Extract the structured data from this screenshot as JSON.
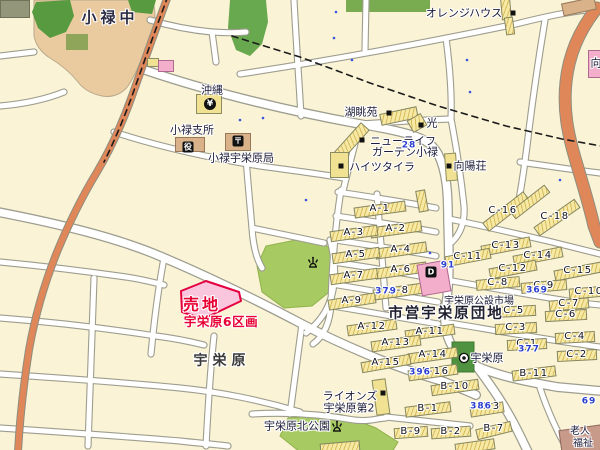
{
  "colors": {
    "background": "#FAF3D5",
    "road_fill": "#FFFFFF",
    "road_casing": "#9D9D8F",
    "main_road_orange": "#DF8759",
    "school_ground_tan": "#EACBA0",
    "park_green": "#A7CB62",
    "dark_green": "#579A40",
    "apartment_yellow": "#F6E9A4",
    "sale_site_pink": "#F9C6DD",
    "sale_site_red": "#E80033",
    "market_pink": "#F3AECB",
    "label_navy": "#1C1C3A",
    "blue_number": "#2A3FD0"
  },
  "map": {
    "labels": [
      {
        "text": "小禄中",
        "x": 110,
        "y": 18,
        "k": "place-lg",
        "name": "label-oroku-junior-high"
      },
      {
        "text": "オレンジハウス",
        "x": 464,
        "y": 13,
        "k": "fac",
        "name": "label-orange-house"
      },
      {
        "text": "沖縄",
        "x": 212,
        "y": 90,
        "k": "fac",
        "name": "label-okinawa-bank"
      },
      {
        "text": "湖眺苑",
        "x": 361,
        "y": 112,
        "k": "fac",
        "name": "label-kochoen"
      },
      {
        "text": "光",
        "x": 432,
        "y": 123,
        "k": "fac",
        "name": "label-hikari"
      },
      {
        "text": "ニューライフ",
        "x": 403,
        "y": 141,
        "k": "fac",
        "name": "label-new-life-line1"
      },
      {
        "text": "ガーデン小禄",
        "x": 405,
        "y": 152,
        "k": "fac",
        "name": "label-new-life-line2"
      },
      {
        "text": "ハイツタイラ",
        "x": 382,
        "y": 167,
        "k": "fac",
        "name": "label-heights-taira"
      },
      {
        "text": "向陽荘",
        "x": 470,
        "y": 166,
        "k": "fac",
        "name": "label-koyoso"
      },
      {
        "text": "小禄支所",
        "x": 192,
        "y": 130,
        "k": "fac",
        "name": "label-oroku-branch-office"
      },
      {
        "text": "小禄宇栄原局",
        "x": 241,
        "y": 158,
        "k": "fac",
        "name": "label-oroku-uebaru-post-office"
      },
      {
        "text": "宇栄原公設市場",
        "x": 479,
        "y": 302,
        "k": "fac-sm",
        "name": "label-uebaru-public-market"
      },
      {
        "text": "市営宇栄原団地",
        "x": 446,
        "y": 314,
        "k": "place-md",
        "name": "label-shiei-uebaru-danchi"
      },
      {
        "text": "宇栄原",
        "x": 222,
        "y": 361,
        "k": "place",
        "name": "label-uebaru"
      },
      {
        "text": "ライオンズ",
        "x": 350,
        "y": 396,
        "k": "fac",
        "name": "label-lions-line1"
      },
      {
        "text": "宇栄原第2",
        "x": 349,
        "y": 408,
        "k": "fac",
        "name": "label-lions-line2"
      },
      {
        "text": "宇栄原北公園",
        "x": 297,
        "y": 426,
        "k": "fac",
        "name": "label-uebaru-kita-park"
      },
      {
        "text": "宇栄原",
        "x": 487,
        "y": 358,
        "k": "fac",
        "name": "label-uebaru-bus-stop"
      },
      {
        "text": "老人",
        "x": 580,
        "y": 432,
        "k": "fac-sm",
        "name": "label-rojin-line1"
      },
      {
        "text": "福祉",
        "x": 583,
        "y": 444,
        "k": "fac-sm",
        "name": "label-rojin-line2"
      },
      {
        "text": "向",
        "x": 596,
        "y": 63,
        "k": "fac",
        "name": "label-mukai-partial"
      },
      {
        "text": "売地",
        "x": 202,
        "y": 305,
        "k": "sale1",
        "name": "sale-site-label"
      },
      {
        "text": "宇栄原6区画",
        "x": 221,
        "y": 322,
        "k": "sale2",
        "name": "sale-site-sublabel"
      },
      {
        "text": "A-1",
        "x": 380,
        "y": 209,
        "k": "block"
      },
      {
        "text": "A-2",
        "x": 396,
        "y": 229,
        "k": "block"
      },
      {
        "text": "A-3",
        "x": 354,
        "y": 233,
        "k": "block"
      },
      {
        "text": "A-4",
        "x": 401,
        "y": 250,
        "k": "block"
      },
      {
        "text": "A-5",
        "x": 356,
        "y": 255,
        "k": "block"
      },
      {
        "text": "A-6",
        "x": 401,
        "y": 270,
        "k": "block"
      },
      {
        "text": "A-7",
        "x": 354,
        "y": 276,
        "k": "block"
      },
      {
        "text": "A-8",
        "x": 399,
        "y": 291,
        "k": "block"
      },
      {
        "text": "A-9",
        "x": 352,
        "y": 301,
        "k": "block"
      },
      {
        "text": "A-11",
        "x": 430,
        "y": 332,
        "k": "block"
      },
      {
        "text": "A-12",
        "x": 372,
        "y": 327,
        "k": "block"
      },
      {
        "text": "A-13",
        "x": 396,
        "y": 343,
        "k": "block"
      },
      {
        "text": "A-14",
        "x": 433,
        "y": 355,
        "k": "block"
      },
      {
        "text": "A-15",
        "x": 386,
        "y": 363,
        "k": "block"
      },
      {
        "text": "A-16",
        "x": 435,
        "y": 372,
        "k": "block"
      },
      {
        "text": "B-1",
        "x": 428,
        "y": 409,
        "k": "block"
      },
      {
        "text": "B-2",
        "x": 451,
        "y": 432,
        "k": "block"
      },
      {
        "text": "B-3",
        "x": 490,
        "y": 407,
        "k": "block"
      },
      {
        "text": "B-7",
        "x": 494,
        "y": 429,
        "k": "block"
      },
      {
        "text": "B-9",
        "x": 411,
        "y": 432,
        "k": "block"
      },
      {
        "text": "B-10",
        "x": 455,
        "y": 387,
        "k": "block"
      },
      {
        "text": "B-11",
        "x": 534,
        "y": 374,
        "k": "block"
      },
      {
        "text": "C-1",
        "x": 527,
        "y": 344,
        "k": "block"
      },
      {
        "text": "C-2",
        "x": 577,
        "y": 355,
        "k": "block"
      },
      {
        "text": "C-3",
        "x": 516,
        "y": 328,
        "k": "block"
      },
      {
        "text": "C-4",
        "x": 575,
        "y": 337,
        "k": "block"
      },
      {
        "text": "C-5",
        "x": 514,
        "y": 311,
        "k": "block"
      },
      {
        "text": "C-6",
        "x": 566,
        "y": 315,
        "k": "block"
      },
      {
        "text": "C-7",
        "x": 569,
        "y": 304,
        "k": "block"
      },
      {
        "text": "C-8",
        "x": 498,
        "y": 283,
        "k": "block"
      },
      {
        "text": "C-9",
        "x": 544,
        "y": 286,
        "k": "block"
      },
      {
        "text": "C-10",
        "x": 589,
        "y": 292,
        "k": "block"
      },
      {
        "text": "C-11",
        "x": 468,
        "y": 257,
        "k": "block"
      },
      {
        "text": "C-12",
        "x": 513,
        "y": 269,
        "k": "block"
      },
      {
        "text": "C-13",
        "x": 506,
        "y": 246,
        "k": "block"
      },
      {
        "text": "C-14",
        "x": 538,
        "y": 256,
        "k": "block"
      },
      {
        "text": "C-15",
        "x": 578,
        "y": 271,
        "k": "block"
      },
      {
        "text": "C-16",
        "x": 503,
        "y": 211,
        "k": "block"
      },
      {
        "text": "C-18",
        "x": 555,
        "y": 217,
        "k": "block"
      },
      {
        "text": "379",
        "x": 386,
        "y": 292,
        "k": "blue"
      },
      {
        "text": "369",
        "x": 537,
        "y": 291,
        "k": "blue"
      },
      {
        "text": "377",
        "x": 529,
        "y": 350,
        "k": "blue"
      },
      {
        "text": "396",
        "x": 420,
        "y": 373,
        "k": "blue"
      },
      {
        "text": "386",
        "x": 481,
        "y": 407,
        "k": "blue"
      },
      {
        "text": "91",
        "x": 448,
        "y": 266,
        "k": "blue"
      },
      {
        "text": "69",
        "x": 589,
        "y": 402,
        "k": "blue"
      },
      {
        "text": "28",
        "x": 409,
        "y": 146,
        "k": "blue"
      }
    ],
    "buildings": [
      {
        "n": "apartment-bar-a1",
        "k": "bar",
        "x": 380,
        "y": 209,
        "w": 52,
        "h": 11,
        "a": -8
      },
      {
        "n": "apartment-bar-a2",
        "k": "bar",
        "x": 396,
        "y": 229,
        "w": 52,
        "h": 11,
        "a": -8
      },
      {
        "n": "apartment-bar-a3",
        "k": "bar",
        "x": 354,
        "y": 233,
        "w": 48,
        "h": 11,
        "a": -8
      },
      {
        "n": "apartment-bar-a4",
        "k": "bar",
        "x": 401,
        "y": 250,
        "w": 52,
        "h": 11,
        "a": -8
      },
      {
        "n": "apartment-bar-a5",
        "k": "bar",
        "x": 356,
        "y": 255,
        "w": 48,
        "h": 11,
        "a": -8
      },
      {
        "n": "apartment-bar-a6",
        "k": "bar",
        "x": 401,
        "y": 270,
        "w": 52,
        "h": 11,
        "a": -8
      },
      {
        "n": "apartment-bar-a7",
        "k": "bar",
        "x": 354,
        "y": 276,
        "w": 48,
        "h": 11,
        "a": -8
      },
      {
        "n": "apartment-bar-a8",
        "k": "bar",
        "x": 399,
        "y": 291,
        "w": 52,
        "h": 11,
        "a": -8
      },
      {
        "n": "apartment-bar-a9",
        "k": "bar",
        "x": 352,
        "y": 301,
        "w": 48,
        "h": 11,
        "a": -9
      },
      {
        "n": "apartment-bar-a11",
        "k": "bar",
        "x": 430,
        "y": 332,
        "w": 50,
        "h": 11,
        "a": -8
      },
      {
        "n": "apartment-bar-a12",
        "k": "bar",
        "x": 372,
        "y": 327,
        "w": 50,
        "h": 11,
        "a": -8
      },
      {
        "n": "apartment-bar-a13",
        "k": "bar",
        "x": 396,
        "y": 343,
        "w": 50,
        "h": 11,
        "a": -8
      },
      {
        "n": "apartment-bar-a14",
        "k": "bar",
        "x": 433,
        "y": 355,
        "w": 50,
        "h": 11,
        "a": -8
      },
      {
        "n": "apartment-bar-a15",
        "k": "bar",
        "x": 386,
        "y": 363,
        "w": 50,
        "h": 11,
        "a": -10
      },
      {
        "n": "apartment-bar-a16",
        "k": "bar",
        "x": 433,
        "y": 372,
        "w": 50,
        "h": 11,
        "a": -8
      },
      {
        "n": "apartment-bar-b1",
        "k": "bar",
        "x": 428,
        "y": 409,
        "w": 46,
        "h": 11,
        "a": -7
      },
      {
        "n": "apartment-bar-b2",
        "k": "bar",
        "x": 451,
        "y": 432,
        "w": 40,
        "h": 11,
        "a": -4
      },
      {
        "n": "apartment-bar-b3",
        "k": "bar",
        "x": 487,
        "y": 409,
        "w": 34,
        "h": 11,
        "a": -9
      },
      {
        "n": "apartment-bar-b7",
        "k": "bar",
        "x": 494,
        "y": 430,
        "w": 36,
        "h": 11,
        "a": -14
      },
      {
        "n": "apartment-bar-b9",
        "k": "bar",
        "x": 411,
        "y": 432,
        "w": 34,
        "h": 11,
        "a": -4
      },
      {
        "n": "apartment-bar-b10",
        "k": "bar",
        "x": 455,
        "y": 387,
        "w": 48,
        "h": 11,
        "a": -8
      },
      {
        "n": "apartment-bar-b11",
        "k": "bar",
        "x": 534,
        "y": 373,
        "w": 44,
        "h": 11,
        "a": -7
      },
      {
        "n": "apartment-bar-c16",
        "k": "bar",
        "x": 506,
        "y": 211,
        "w": 52,
        "h": 11,
        "a": -38
      },
      {
        "n": "apartment-bar",
        "k": "bar",
        "x": 530,
        "y": 202,
        "w": 44,
        "h": 10,
        "a": -38
      },
      {
        "n": "apartment-bar-c18",
        "k": "bar",
        "x": 557,
        "y": 217,
        "w": 50,
        "h": 11,
        "a": -35
      },
      {
        "n": "apartment-bar-c13",
        "k": "bar",
        "x": 506,
        "y": 246,
        "w": 50,
        "h": 11,
        "a": -11
      },
      {
        "n": "apartment-bar-c11",
        "k": "bar",
        "x": 468,
        "y": 257,
        "w": 46,
        "h": 11,
        "a": -11
      },
      {
        "n": "apartment-bar-c14",
        "k": "bar",
        "x": 538,
        "y": 256,
        "w": 50,
        "h": 11,
        "a": -11
      },
      {
        "n": "apartment-bar-c12",
        "k": "bar",
        "x": 513,
        "y": 269,
        "w": 48,
        "h": 11,
        "a": -11
      },
      {
        "n": "apartment-bar-c15",
        "k": "bar",
        "x": 578,
        "y": 271,
        "w": 48,
        "h": 11,
        "a": -11
      },
      {
        "n": "apartment-bar-c8",
        "k": "bar",
        "x": 498,
        "y": 283,
        "w": 44,
        "h": 11,
        "a": -5
      },
      {
        "n": "apartment-bar-c9",
        "k": "bar",
        "x": 544,
        "y": 286,
        "w": 46,
        "h": 11,
        "a": -5
      },
      {
        "n": "apartment-bar-c10",
        "k": "bar",
        "x": 589,
        "y": 292,
        "w": 40,
        "h": 11,
        "a": -5
      },
      {
        "n": "apartment-bar-c7",
        "k": "bar",
        "x": 569,
        "y": 304,
        "w": 40,
        "h": 11,
        "a": -5
      },
      {
        "n": "apartment-bar-c5",
        "k": "bar",
        "x": 514,
        "y": 311,
        "w": 44,
        "h": 11,
        "a": -3
      },
      {
        "n": "apartment-bar-c6",
        "k": "bar",
        "x": 566,
        "y": 315,
        "w": 42,
        "h": 11,
        "a": -3
      },
      {
        "n": "apartment-bar-c3",
        "k": "bar",
        "x": 516,
        "y": 328,
        "w": 42,
        "h": 11,
        "a": -3
      },
      {
        "n": "apartment-bar-c4",
        "k": "bar",
        "x": 575,
        "y": 337,
        "w": 40,
        "h": 11,
        "a": -3
      },
      {
        "n": "apartment-bar-c1",
        "k": "bar",
        "x": 527,
        "y": 344,
        "w": 40,
        "h": 11,
        "a": -3
      },
      {
        "n": "apartment-bar-c2",
        "k": "bar",
        "x": 577,
        "y": 355,
        "w": 40,
        "h": 11,
        "a": -3
      },
      {
        "n": "building-orange-house-1",
        "k": "bar",
        "x": 506,
        "y": 9,
        "w": 10,
        "h": 22,
        "a": -5
      },
      {
        "n": "building-orange-house-2",
        "k": "bar",
        "x": 509,
        "y": 26,
        "w": 9,
        "h": 18,
        "a": -8
      },
      {
        "n": "apartment-bar",
        "k": "bar",
        "x": 422,
        "y": 201,
        "w": 10,
        "h": 22,
        "a": -10
      },
      {
        "n": "apartment-bar",
        "k": "bar",
        "x": 340,
        "y": 447,
        "w": 40,
        "h": 11,
        "a": -5
      },
      {
        "n": "apartment-bar",
        "k": "bar",
        "x": 475,
        "y": 446,
        "w": 40,
        "h": 11,
        "a": -8
      },
      {
        "n": "building-kochoen",
        "k": "bar",
        "x": 399,
        "y": 116,
        "w": 38,
        "h": 12,
        "a": -12
      },
      {
        "n": "building-hikari",
        "k": "bar",
        "x": 417,
        "y": 123,
        "w": 16,
        "h": 14,
        "a": -30
      },
      {
        "n": "building-new-life-garden",
        "k": "bar",
        "x": 352,
        "y": 141,
        "w": 40,
        "h": 12,
        "a": -48
      },
      {
        "n": "building-heights-taira",
        "k": "ybldg",
        "x": 339,
        "y": 165,
        "w": 19,
        "h": 26,
        "a": 0
      },
      {
        "n": "building-koyoso",
        "k": "ybldg",
        "x": 451,
        "y": 167,
        "w": 12,
        "h": 28,
        "a": -4
      },
      {
        "n": "building-lions-uebaru-2",
        "k": "ybldg",
        "x": 381,
        "y": 397,
        "w": 14,
        "h": 36,
        "a": -8
      },
      {
        "n": "building-bank-okinawa",
        "k": "ybldg",
        "x": 209,
        "y": 104,
        "w": 26,
        "h": 20,
        "a": 0
      },
      {
        "n": "building",
        "k": "ybldg",
        "x": 153,
        "y": 62,
        "w": 12,
        "h": 9,
        "a": 0
      },
      {
        "n": "building-oroku-branch-office",
        "k": "tbldg",
        "x": 190,
        "y": 144,
        "w": 30,
        "h": 15,
        "a": 0
      },
      {
        "n": "building-post-office",
        "k": "tbldg",
        "x": 238,
        "y": 142,
        "w": 26,
        "h": 18,
        "a": 0
      },
      {
        "n": "building",
        "k": "tbldg",
        "x": 579,
        "y": 6,
        "w": 34,
        "h": 13,
        "a": -12
      },
      {
        "n": "building-public-market",
        "k": "pbldg",
        "x": 434,
        "y": 278,
        "w": 30,
        "h": 32,
        "a": -10
      },
      {
        "n": "building",
        "k": "pbldg",
        "x": 166,
        "y": 66,
        "w": 16,
        "h": 12,
        "a": 0
      },
      {
        "n": "building",
        "k": "pbldg",
        "x": 595,
        "y": 64,
        "w": 14,
        "h": 28,
        "a": 0
      },
      {
        "n": "building-rojin-center",
        "k": "brbldg",
        "x": 583,
        "y": 440,
        "w": 46,
        "h": 26,
        "a": -8
      },
      {
        "n": "building",
        "k": "gbldg",
        "x": 15,
        "y": 9,
        "w": 30,
        "h": 18,
        "a": 0
      }
    ],
    "icons": [
      {
        "t": "marker",
        "x": 513,
        "y": 13,
        "name": "building-marker-icon"
      },
      {
        "t": "marker",
        "x": 389,
        "y": 113,
        "name": "building-marker-icon"
      },
      {
        "t": "marker",
        "x": 421,
        "y": 125,
        "name": "building-marker-icon"
      },
      {
        "t": "marker",
        "x": 362,
        "y": 140,
        "name": "building-marker-icon"
      },
      {
        "t": "marker",
        "x": 341,
        "y": 166,
        "name": "building-marker-icon"
      },
      {
        "t": "marker",
        "x": 449,
        "y": 166,
        "name": "building-marker-icon"
      },
      {
        "t": "marker",
        "x": 383,
        "y": 393,
        "name": "building-marker-icon"
      },
      {
        "t": "badge",
        "glyph": "役",
        "x": 188,
        "y": 147,
        "name": "town-office-icon"
      },
      {
        "t": "badge",
        "glyph": "〒",
        "x": 238,
        "y": 141,
        "name": "post-office-icon"
      },
      {
        "t": "round",
        "glyph": "¥",
        "x": 210,
        "y": 104,
        "name": "bank-icon"
      },
      {
        "t": "badge",
        "glyph": "D",
        "x": 431,
        "y": 272,
        "name": "department-store-icon"
      },
      {
        "t": "fountain",
        "x": 313,
        "y": 262,
        "name": "park-fountain-icon"
      },
      {
        "t": "fountain",
        "x": 337,
        "y": 426,
        "name": "park-fountain-icon"
      },
      {
        "t": "bus",
        "x": 464,
        "y": 358,
        "name": "bus-stop-icon"
      }
    ]
  }
}
